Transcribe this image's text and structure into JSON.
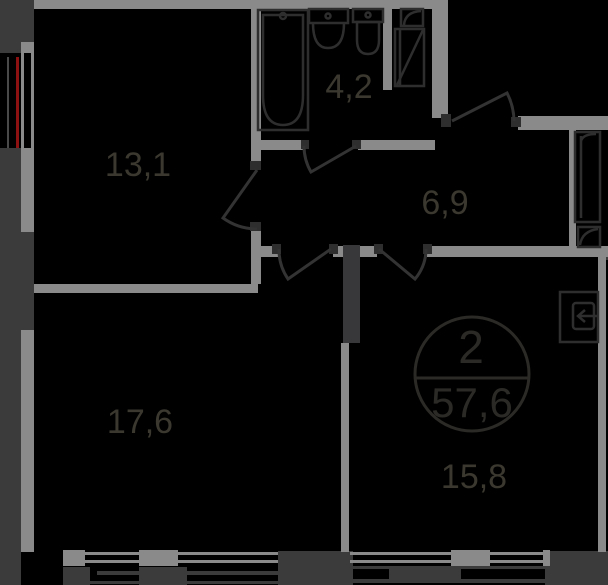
{
  "floor_plan": {
    "apartment": {
      "number": "2",
      "total_area": "57,6"
    },
    "rooms": [
      {
        "name": "room",
        "area": "13,1"
      },
      {
        "name": "bathroom",
        "area": "4,2"
      },
      {
        "name": "hallway",
        "area": "6,9"
      },
      {
        "name": "living-room",
        "area": "17,6"
      },
      {
        "name": "bedroom",
        "area": "15,8"
      }
    ],
    "colors": {
      "background": "#000000",
      "wall": "#8a8a8a",
      "dim_outline": "#3b3b3b",
      "fixture_outline": "#2e2e2e",
      "label_text": "#3a382f",
      "stamp_text": "#2b2a26",
      "red_marking": "#8e1111"
    }
  }
}
